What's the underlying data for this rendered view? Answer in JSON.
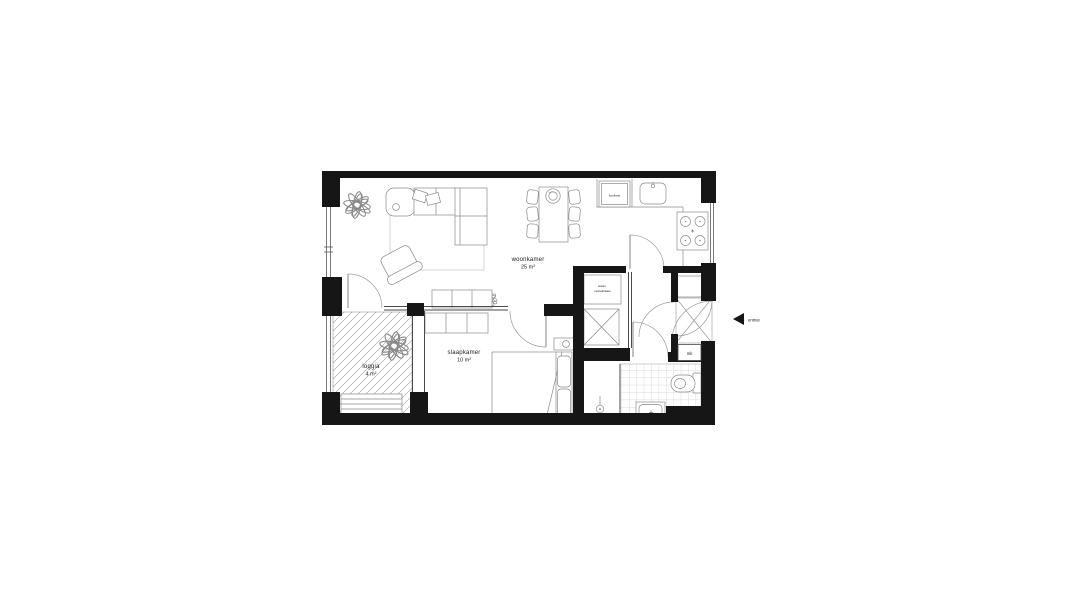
{
  "window": {
    "width": 1092,
    "height": 606,
    "background": "#ffffff"
  },
  "floorplan": {
    "kind": "apartment floor plan",
    "language": "Dutch",
    "wall_color": "#161616",
    "furniture_line_color": "#8a8a8a",
    "rooms": [
      {
        "id": "woonkamer",
        "label": "woonkamer",
        "area": "25 m²"
      },
      {
        "id": "slaapkamer",
        "label": "slaapkamer",
        "area": "10 m²"
      },
      {
        "id": "loggia",
        "label": "loggia",
        "area": "4 m²"
      }
    ],
    "fixtures": {
      "koelkast_label": "koelkast",
      "washer_label_line1": "wasm.",
      "washer_label_line2": "opstelplaats",
      "meterkast_label": "mk",
      "entrance_label": "entree"
    }
  }
}
